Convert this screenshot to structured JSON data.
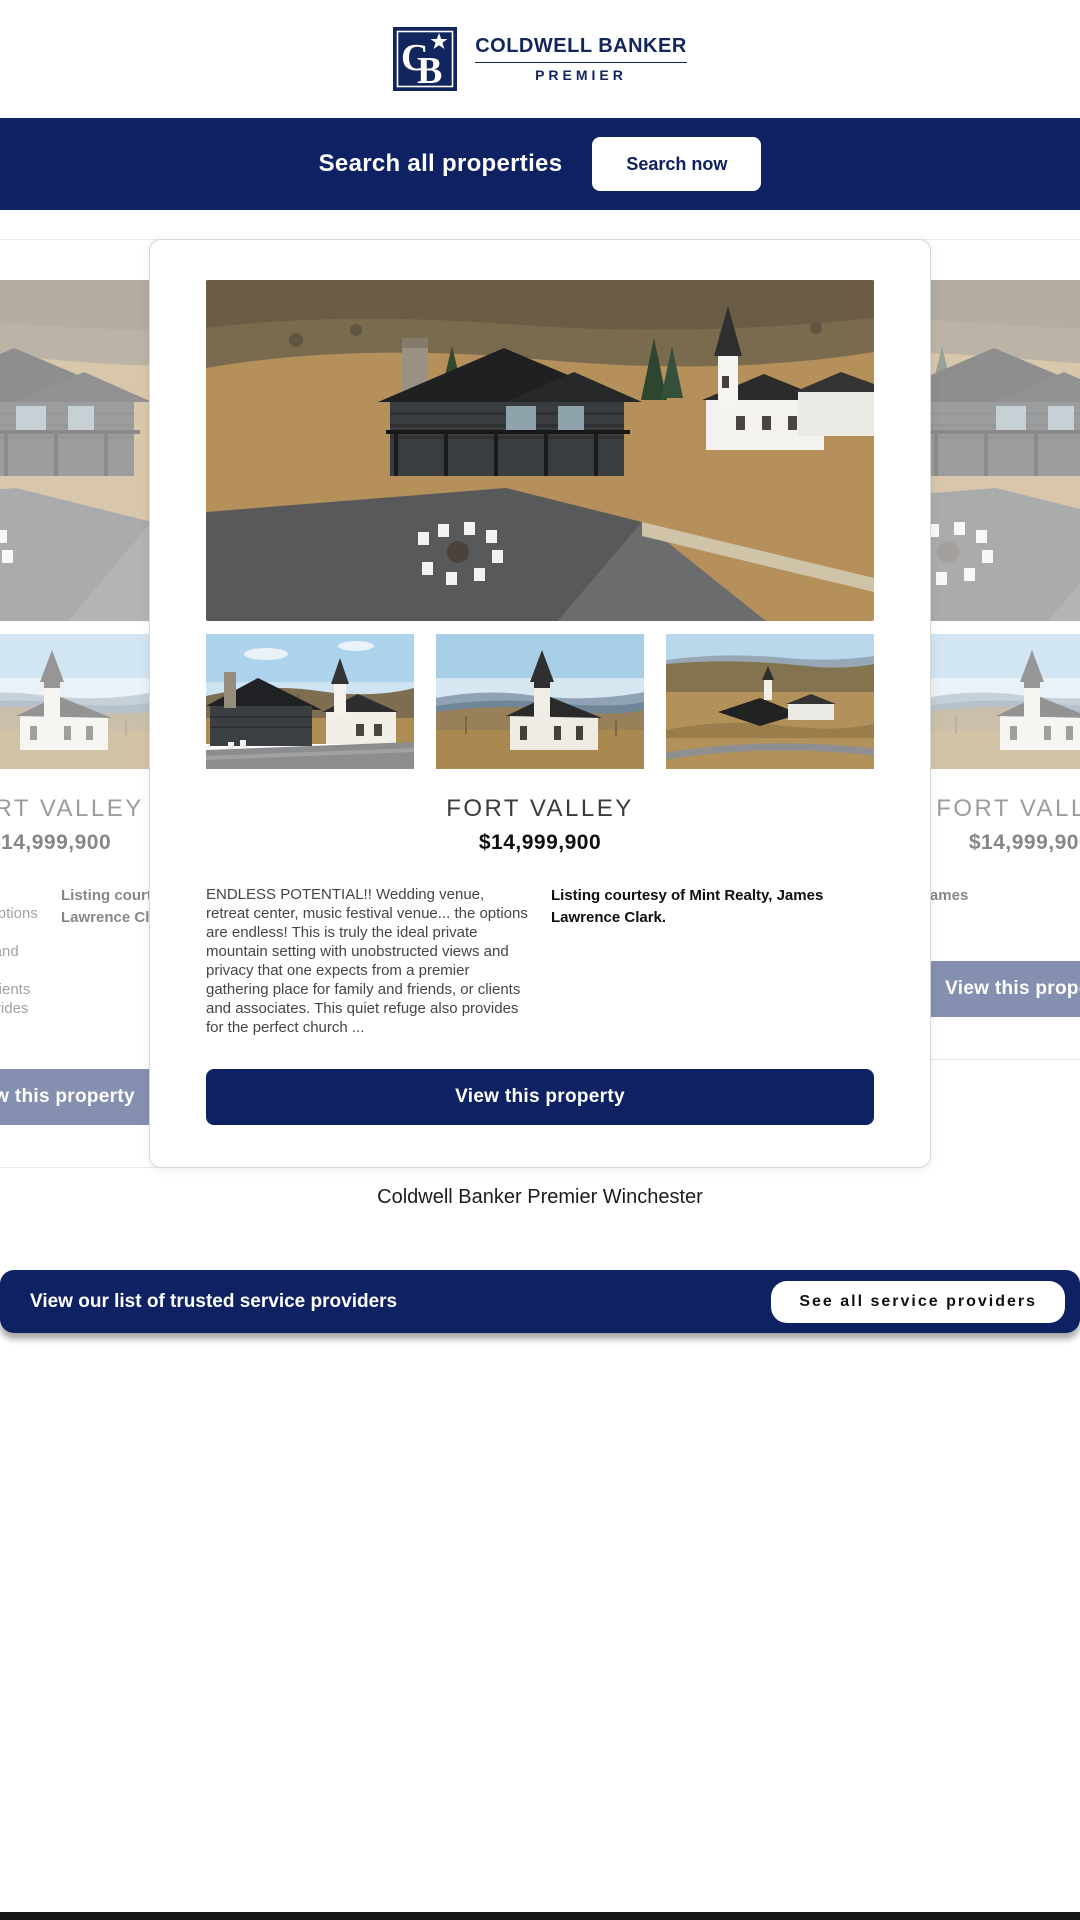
{
  "brand": {
    "monogram_c": "C",
    "monogram_b": "B",
    "name_line1": "COLDWELL BANKER",
    "name_line2": "PREMIER"
  },
  "search_banner": {
    "label": "Search all properties",
    "button": "Search now"
  },
  "listing_card": {
    "title": "FORT VALLEY",
    "price": "$14,999,900",
    "description": "ENDLESS POTENTIAL!! Wedding venue, retreat center, music festival venue... the options are endless! This is truly the ideal private mountain setting with unobstructed views and privacy that one expects from a premier gathering place for family and friends, or clients and associates. This quiet refuge also provides for the perfect church ...",
    "listing_courtesy": "Listing courtesy of Mint Realty, James Lawrence Clark.",
    "view_button": "View this property"
  },
  "office_name": "Coldwell Banker Premier Winchester",
  "providers_banner": {
    "label": "View our list of trusted service providers",
    "button": "See all service providers"
  },
  "colors": {
    "navy": "#0d2163",
    "white": "#ffffff",
    "faded_side_button": "#8894b4"
  }
}
